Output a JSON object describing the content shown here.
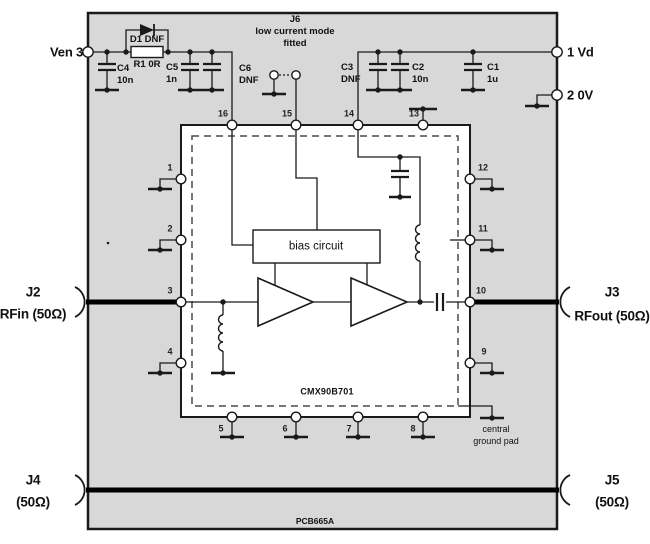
{
  "board": {
    "name": "PCB665A"
  },
  "chip": {
    "name": "CMX90B701",
    "bias_label": "bias circuit",
    "central_pad_line1": "central",
    "central_pad_line2": "ground pad"
  },
  "terminals": {
    "ven": "Ven 3",
    "vd": "1 Vd",
    "gnd": "2 0V"
  },
  "components": {
    "d1": {
      "label": "D1 DNF"
    },
    "r1": {
      "label": "R1 0R"
    },
    "c4": {
      "ref": "C4",
      "val": "10n"
    },
    "c5": {
      "ref": "C5",
      "val": "1n"
    },
    "c6": {
      "ref": "C6",
      "val": "DNF"
    },
    "c3": {
      "ref": "C3",
      "val": "DNF"
    },
    "c2": {
      "ref": "C2",
      "val": "10n"
    },
    "c1": {
      "ref": "C1",
      "val": "1u"
    },
    "j6": {
      "ref": "J6",
      "desc1": "low current mode",
      "desc2": "fitted"
    }
  },
  "connectors": {
    "j2": {
      "ref": "J2",
      "desc": "RFin (50Ω)"
    },
    "j3": {
      "ref": "J3",
      "desc": "RFout (50Ω)"
    },
    "j4": {
      "ref": "J4",
      "desc": "(50Ω)"
    },
    "j5": {
      "ref": "J5",
      "desc": "(50Ω)"
    }
  },
  "pins": {
    "top": [
      "16",
      "15",
      "14",
      "13"
    ],
    "bottom": [
      "5",
      "6",
      "7",
      "8"
    ],
    "left": [
      "1",
      "2",
      "3",
      "4"
    ],
    "right": [
      "12",
      "11",
      "10",
      "9"
    ]
  },
  "colors": {
    "board_fill": "#d8d8d8",
    "line": "#1a1a1a"
  }
}
